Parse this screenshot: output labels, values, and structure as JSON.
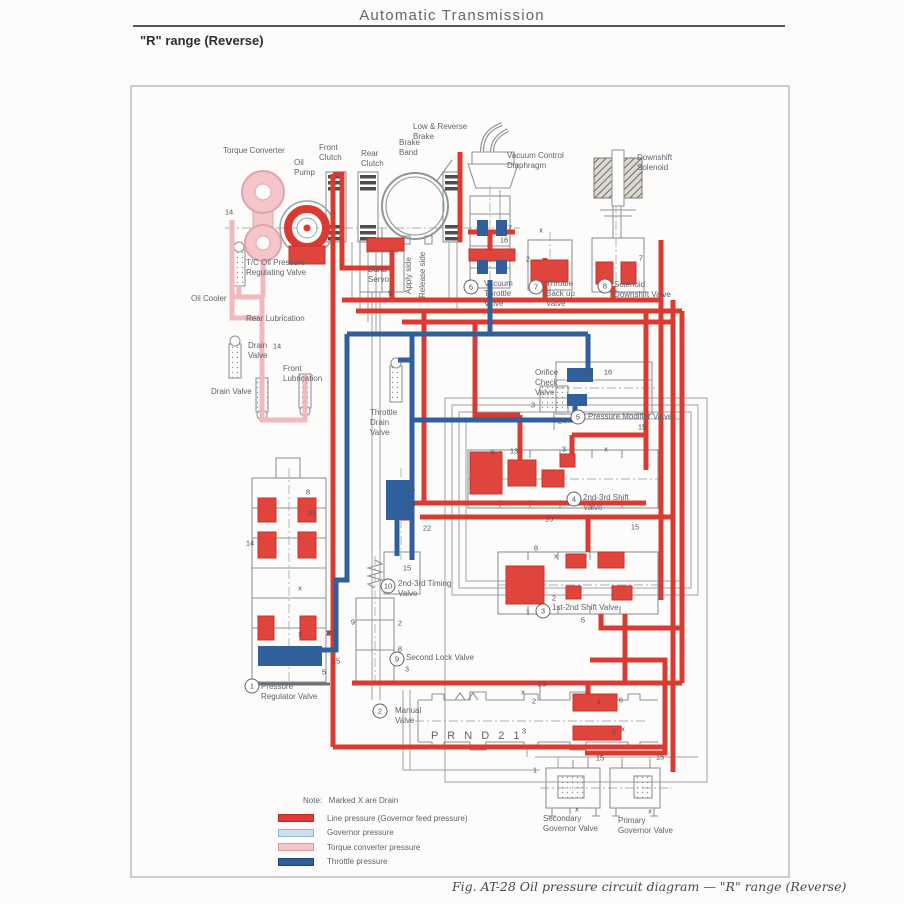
{
  "page": {
    "header_title": "Automatic Transmission",
    "range_label": "\"R\" range (Reverse)",
    "caption": "Fig. AT-28  Oil pressure circuit diagram — \"R\" range (Reverse)"
  },
  "legend": {
    "note": "Note:   Marked X are Drain",
    "items": [
      {
        "label": "Line pressure (Governor feed pressure)",
        "color": "#e23b36",
        "border": "#b02a26"
      },
      {
        "label": "Governor pressure",
        "color": "#cdddeb",
        "border": "#8fb4cd"
      },
      {
        "label": "Torque converter pressure",
        "color": "#f4c6ca",
        "border": "#d99ba1"
      },
      {
        "label": "Throttle pressure",
        "color": "#30609b",
        "border": "#1f4372"
      }
    ]
  },
  "diagram": {
    "labels": [
      {
        "name": "torque-converter",
        "text": "Torque Converter",
        "x": 223,
        "y": 146
      },
      {
        "name": "oil-pump",
        "text": "Oil\nPump",
        "x": 294,
        "y": 158
      },
      {
        "name": "front-clutch",
        "text": "Front\nClutch",
        "x": 319,
        "y": 143
      },
      {
        "name": "rear-clutch",
        "text": "Rear\nClutch",
        "x": 361,
        "y": 149
      },
      {
        "name": "brake-band",
        "text": "Brake\nBand",
        "x": 399,
        "y": 138
      },
      {
        "name": "low-reverse-brake",
        "text": "Low & Reverse\nBrake",
        "x": 413,
        "y": 122
      },
      {
        "name": "vacuum-control-diaphragm",
        "text": "Vacuum Control\nDiaphragm",
        "x": 507,
        "y": 151
      },
      {
        "name": "downshift-solenoid",
        "text": "Downshift\nSolenoid",
        "x": 637,
        "y": 153
      },
      {
        "name": "tc-oil-pressure-regulating-valve",
        "text": "T/C Oil Pressure\nRegulating Valve",
        "x": 246,
        "y": 258
      },
      {
        "name": "oil-cooler",
        "text": "Oil Cooler",
        "x": 191,
        "y": 294
      },
      {
        "name": "rear-lubrication",
        "text": "Rear Lubrication",
        "x": 246,
        "y": 314
      },
      {
        "name": "drain-valve-upper",
        "text": "Drain\nValve",
        "x": 248,
        "y": 341
      },
      {
        "name": "front-lubrication",
        "text": "Front\nLubrication",
        "x": 283,
        "y": 364
      },
      {
        "name": "drain-valve-lower",
        "text": "Drain Valve",
        "x": 211,
        "y": 387
      },
      {
        "name": "band-servo",
        "text": "Band\nServo",
        "x": 368,
        "y": 265
      },
      {
        "name": "apply-side",
        "text": "Apply side",
        "x": 404,
        "y": 294,
        "rot": -90
      },
      {
        "name": "release-side",
        "text": "Release side",
        "x": 418,
        "y": 298,
        "rot": -90
      },
      {
        "name": "vacuum-throttle-valve",
        "text": "Vacuum\nThrottle\nValve",
        "x": 484,
        "y": 279
      },
      {
        "name": "throttle-back-up-valve",
        "text": "Throttle\nBack up\nValve",
        "x": 546,
        "y": 279
      },
      {
        "name": "solenoid-downshift-valve",
        "text": "Solenoid\nDownshift Valve",
        "x": 614,
        "y": 280
      },
      {
        "name": "orifice-check-valve",
        "text": "Orifice\nCheck\nValve",
        "x": 535,
        "y": 368
      },
      {
        "name": "pressure-modifier-valve",
        "text": "Pressure Modifier Valve",
        "x": 588,
        "y": 412
      },
      {
        "name": "throttle-drain-valve",
        "text": "Throttle\nDrain\nValve",
        "x": 370,
        "y": 408
      },
      {
        "name": "shift-valve-2nd-3rd",
        "text": "2nd-3rd Shift\nValve",
        "x": 583,
        "y": 493
      },
      {
        "name": "timing-valve-2nd-3rd",
        "text": "2nd-3rd Timing\nValve",
        "x": 398,
        "y": 579
      },
      {
        "name": "shift-valve-1st-2nd",
        "text": "1st-2nd Shift Valve",
        "x": 552,
        "y": 603
      },
      {
        "name": "second-lock-valve",
        "text": "Second Lock Valve",
        "x": 406,
        "y": 653
      },
      {
        "name": "pressure-regulator-valve",
        "text": "Pressure\nRegulator Valve",
        "x": 261,
        "y": 682
      },
      {
        "name": "manual-valve",
        "text": "Manual\nValve",
        "x": 395,
        "y": 706
      },
      {
        "name": "prnd21",
        "text": "P R N D 2 1",
        "x": 431,
        "y": 730,
        "size": 11,
        "ls": 3
      },
      {
        "name": "secondary-governor-valve",
        "text": "Secondary\nGovernor Valve",
        "x": 543,
        "y": 814
      },
      {
        "name": "primary-governor-valve",
        "text": "Primary\nGovernor Valve",
        "x": 618,
        "y": 816
      }
    ],
    "valve_badges": [
      {
        "n": "1",
        "x": 252,
        "y": 686
      },
      {
        "n": "2",
        "x": 380,
        "y": 711
      },
      {
        "n": "3",
        "x": 543,
        "y": 611
      },
      {
        "n": "4",
        "x": 574,
        "y": 499
      },
      {
        "n": "5",
        "x": 578,
        "y": 417
      },
      {
        "n": "6",
        "x": 471,
        "y": 287
      },
      {
        "n": "7",
        "x": 536,
        "y": 287
      },
      {
        "n": "8",
        "x": 605,
        "y": 286
      },
      {
        "n": "9",
        "x": 397,
        "y": 659
      },
      {
        "n": "10",
        "x": 388,
        "y": 586
      }
    ],
    "port_numbers": [
      {
        "t": "14",
        "x": 229,
        "y": 212
      },
      {
        "t": "14",
        "x": 277,
        "y": 346
      },
      {
        "t": "9",
        "x": 390,
        "y": 293
      },
      {
        "t": "16",
        "x": 504,
        "y": 240
      },
      {
        "t": "17",
        "x": 508,
        "y": 228
      },
      {
        "t": "2",
        "x": 528,
        "y": 259
      },
      {
        "t": "x",
        "x": 541,
        "y": 230
      },
      {
        "t": "7",
        "x": 641,
        "y": 258
      },
      {
        "t": "18",
        "x": 589,
        "y": 372
      },
      {
        "t": "16",
        "x": 608,
        "y": 372
      },
      {
        "t": "3",
        "x": 533,
        "y": 405
      },
      {
        "t": "24",
        "x": 562,
        "y": 421
      },
      {
        "t": "15",
        "x": 642,
        "y": 427
      },
      {
        "t": "6",
        "x": 493,
        "y": 452
      },
      {
        "t": "13",
        "x": 514,
        "y": 451
      },
      {
        "t": "3",
        "x": 564,
        "y": 449
      },
      {
        "t": "x",
        "x": 606,
        "y": 449
      },
      {
        "t": "8",
        "x": 308,
        "y": 492
      },
      {
        "t": "20",
        "x": 311,
        "y": 513
      },
      {
        "t": "14",
        "x": 250,
        "y": 543
      },
      {
        "t": "15",
        "x": 411,
        "y": 489
      },
      {
        "t": "10",
        "x": 411,
        "y": 505
      },
      {
        "t": "22",
        "x": 427,
        "y": 528
      },
      {
        "t": "15",
        "x": 407,
        "y": 568
      },
      {
        "t": "10",
        "x": 549,
        "y": 519
      },
      {
        "t": "15",
        "x": 635,
        "y": 527
      },
      {
        "t": "8",
        "x": 536,
        "y": 548
      },
      {
        "t": "x",
        "x": 556,
        "y": 556
      },
      {
        "t": "2",
        "x": 554,
        "y": 598
      },
      {
        "t": "1",
        "x": 528,
        "y": 612
      },
      {
        "t": "5",
        "x": 583,
        "y": 620
      },
      {
        "t": "9",
        "x": 353,
        "y": 622
      },
      {
        "t": "2",
        "x": 400,
        "y": 623
      },
      {
        "t": "8",
        "x": 400,
        "y": 649
      },
      {
        "t": "3",
        "x": 407,
        "y": 669
      },
      {
        "t": "21",
        "x": 330,
        "y": 633
      },
      {
        "t": "15",
        "x": 336,
        "y": 661
      },
      {
        "t": "5",
        "x": 324,
        "y": 672
      },
      {
        "t": "x",
        "x": 300,
        "y": 588
      },
      {
        "t": "x",
        "x": 300,
        "y": 634
      },
      {
        "t": "23",
        "x": 542,
        "y": 684
      },
      {
        "t": "2",
        "x": 534,
        "y": 701
      },
      {
        "t": "x",
        "x": 523,
        "y": 692
      },
      {
        "t": "3",
        "x": 524,
        "y": 731
      },
      {
        "t": "4",
        "x": 599,
        "y": 702
      },
      {
        "t": "6",
        "x": 621,
        "y": 700
      },
      {
        "t": "5",
        "x": 614,
        "y": 732
      },
      {
        "t": "x",
        "x": 623,
        "y": 729
      },
      {
        "t": "15",
        "x": 600,
        "y": 758
      },
      {
        "t": "15",
        "x": 660,
        "y": 757
      },
      {
        "t": "1",
        "x": 535,
        "y": 770
      },
      {
        "t": "x",
        "x": 577,
        "y": 809
      },
      {
        "t": "x",
        "x": 650,
        "y": 811
      }
    ]
  }
}
